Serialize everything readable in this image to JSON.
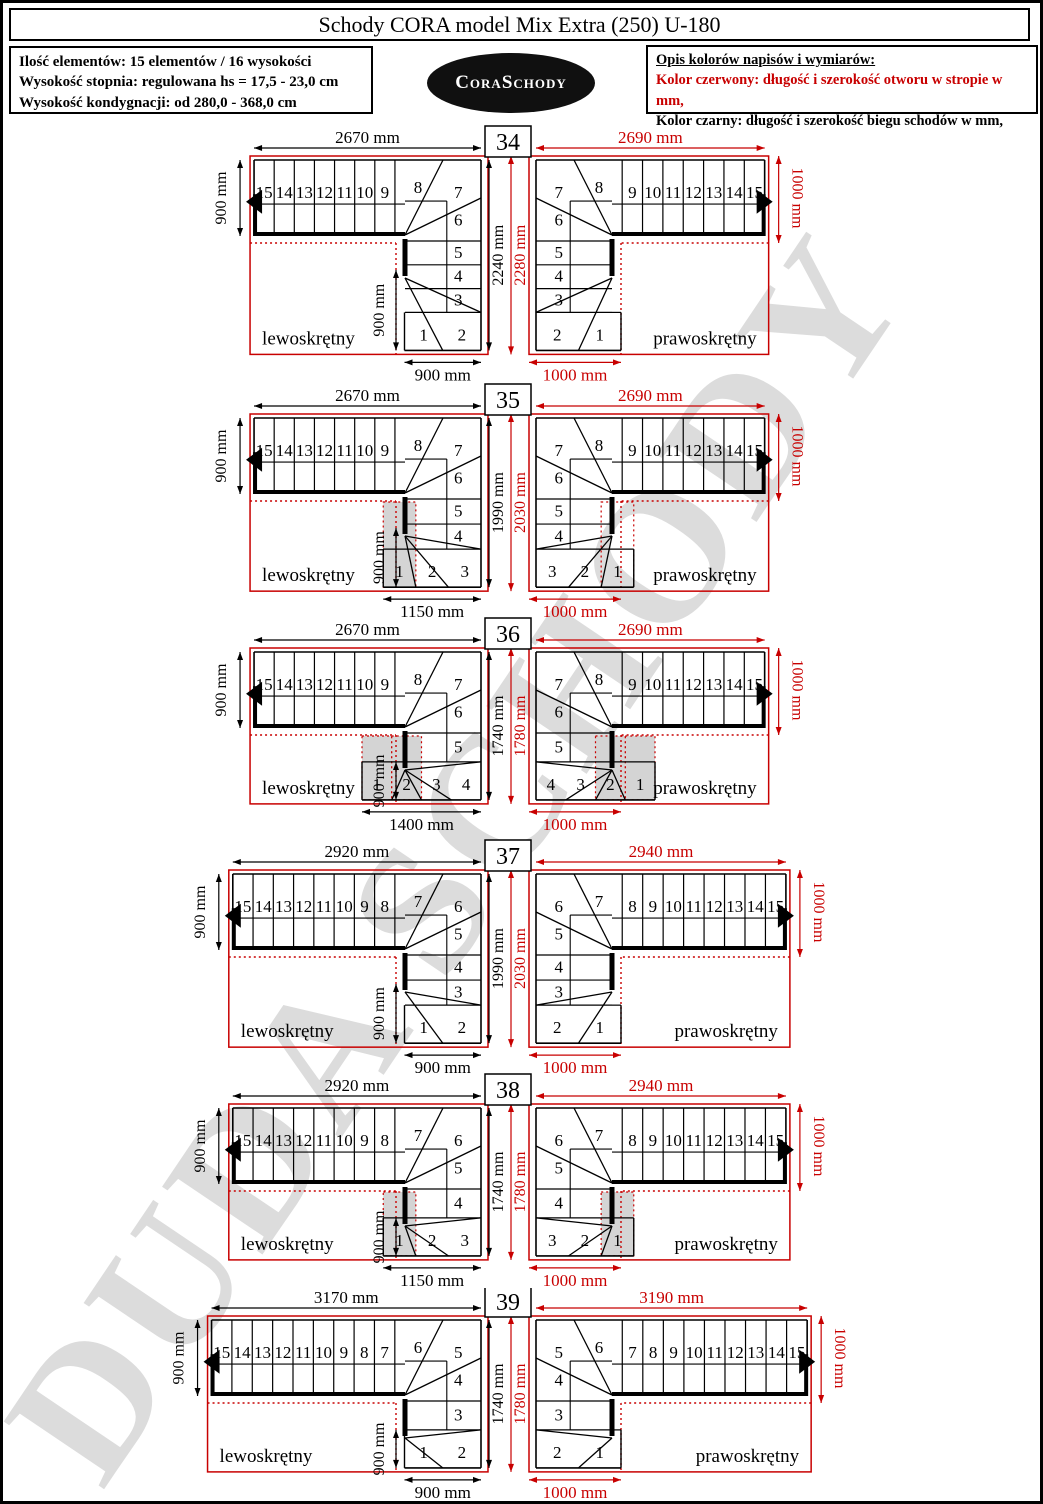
{
  "colors": {
    "red": "#c80000",
    "black": "#000000",
    "grey_step": "#d4d4d4",
    "watermark": "#dcdcdc"
  },
  "header": {
    "title": "Schody CORA model Mix Extra (250) U-180",
    "info_lines": [
      "Ilość elementów: 15 elementów / 16 wysokości",
      "Wysokość stopnia: regulowana  hs = 17,5 - 23,0 cm",
      "Wysokość kondygnacji: od 280,0 - 368,0 cm"
    ],
    "logo_text": "CoraSchody",
    "legend": {
      "heading": "Opis kolorów napisów i wymiarów:",
      "red_line": "Kolor czerwony:  długość i szerokość otworu w stropie w mm,",
      "black_line": "Kolor czarny:  długość i szerokość biegu schodów w mm,"
    }
  },
  "watermark_text": "DUDA SCHODY",
  "rows": [
    {
      "badge": "34",
      "left": {
        "label": "lewoskrętny",
        "top": "2670 mm",
        "side": "900 mm",
        "h_black": "2240 mm",
        "h_red": "2280 mm",
        "bottom": "900 mm",
        "inner": "900 mm",
        "strips": [
          "15",
          "14",
          "13",
          "12",
          "11",
          "10",
          "9"
        ],
        "wedge": "8",
        "corner": "7",
        "column": [
          "6",
          "5",
          "4",
          "3"
        ],
        "bottom_steps": [
          "1",
          "2"
        ],
        "shaded": [],
        "outlined": []
      },
      "right": {
        "label": "prawoskrętny",
        "top": "2690 mm",
        "side": "1000 mm",
        "bottom": "1000 mm",
        "strips": [
          "9",
          "10",
          "11",
          "12",
          "13",
          "14",
          "15"
        ],
        "wedge": "8",
        "corner": "7",
        "column": [
          "6",
          "5",
          "4",
          "3"
        ],
        "bottom_steps": [
          "2",
          "1"
        ],
        "shaded": [],
        "outlined": []
      }
    },
    {
      "badge": "35",
      "left": {
        "label": "lewoskrętny",
        "top": "2670 mm",
        "side": "900 mm",
        "h_black": "1990 mm",
        "h_red": "2030 mm",
        "bottom": "1150 mm",
        "inner": "900 mm",
        "strips": [
          "15",
          "14",
          "13",
          "12",
          "11",
          "10",
          "9"
        ],
        "wedge": "8",
        "corner": "7",
        "column": [
          "6",
          "5",
          "4"
        ],
        "bottom_steps": [
          "1",
          "2",
          "3"
        ],
        "shaded": [
          "1"
        ],
        "outlined": []
      },
      "right": {
        "label": "prawoskrętny",
        "top": "2690 mm",
        "side": "1000 mm",
        "bottom": "1000 mm",
        "strips": [
          "9",
          "10",
          "11",
          "12",
          "13",
          "14",
          "15"
        ],
        "wedge": "8",
        "corner": "7",
        "column": [
          "6",
          "5",
          "4"
        ],
        "bottom_steps": [
          "3",
          "2",
          "1"
        ],
        "shaded": [],
        "outlined": [
          "1"
        ]
      }
    },
    {
      "badge": "36",
      "left": {
        "label": "lewoskrętny",
        "top": "2670 mm",
        "side": "900 mm",
        "h_black": "1740 mm",
        "h_red": "1780 mm",
        "bottom": "1400 mm",
        "inner": "900 mm",
        "strips": [
          "15",
          "14",
          "13",
          "12",
          "11",
          "10",
          "9"
        ],
        "wedge": "8",
        "corner": "7",
        "column": [
          "6",
          "5"
        ],
        "bottom_steps": [
          "1",
          "2",
          "3",
          "4"
        ],
        "shaded": [
          "1",
          "2"
        ],
        "outlined": []
      },
      "right": {
        "label": "prawoskrętny",
        "top": "2690 mm",
        "side": "1000 mm",
        "bottom": "1000 mm",
        "strips": [
          "9",
          "10",
          "11",
          "12",
          "13",
          "14",
          "15"
        ],
        "wedge": "8",
        "corner": "7",
        "column": [
          "6",
          "5"
        ],
        "bottom_steps": [
          "4",
          "3",
          "2",
          "1"
        ],
        "shaded": [
          "2",
          "1"
        ],
        "outlined": []
      }
    },
    {
      "badge": "37",
      "left": {
        "label": "lewoskrętny",
        "top": "2920 mm",
        "side": "900 mm",
        "h_black": "1990 mm",
        "h_red": "2030 mm",
        "bottom": "900 mm",
        "inner": "900 mm",
        "strips": [
          "15",
          "14",
          "13",
          "12",
          "11",
          "10",
          "9",
          "8"
        ],
        "wedge": "7",
        "corner": "6",
        "column": [
          "5",
          "4",
          "3"
        ],
        "bottom_steps": [
          "1",
          "2"
        ],
        "shaded": [],
        "outlined": []
      },
      "right": {
        "label": "prawoskrętny",
        "top": "2940 mm",
        "side": "1000 mm",
        "bottom": "1000 mm",
        "strips": [
          "8",
          "9",
          "10",
          "11",
          "12",
          "13",
          "14",
          "15"
        ],
        "wedge": "7",
        "corner": "6",
        "column": [
          "5",
          "4",
          "3"
        ],
        "bottom_steps": [
          "2",
          "1"
        ],
        "shaded": [],
        "outlined": []
      }
    },
    {
      "badge": "38",
      "left": {
        "label": "lewoskrętny",
        "top": "2920 mm",
        "side": "900 mm",
        "h_black": "1740 mm",
        "h_red": "1780 mm",
        "bottom": "1150 mm",
        "inner": "900 mm",
        "strips": [
          "15",
          "14",
          "13",
          "12",
          "11",
          "10",
          "9",
          "8"
        ],
        "wedge": "7",
        "corner": "6",
        "column": [
          "5",
          "4"
        ],
        "bottom_steps": [
          "1",
          "2",
          "3"
        ],
        "shaded": [
          "1"
        ],
        "outlined": []
      },
      "right": {
        "label": "prawoskrętny",
        "top": "2940 mm",
        "side": "1000 mm",
        "bottom": "1000 mm",
        "strips": [
          "8",
          "9",
          "10",
          "11",
          "12",
          "13",
          "14",
          "15"
        ],
        "wedge": "7",
        "corner": "6",
        "column": [
          "5",
          "4"
        ],
        "bottom_steps": [
          "3",
          "2",
          "1"
        ],
        "shaded": [
          "1"
        ],
        "outlined": []
      }
    },
    {
      "badge": "39",
      "left": {
        "label": "lewoskrętny",
        "top": "3170 mm",
        "side": "900 mm",
        "h_black": "1740 mm",
        "h_red": "1780 mm",
        "bottom": "900 mm",
        "inner": "900 mm",
        "strips": [
          "15",
          "14",
          "13",
          "12",
          "11",
          "10",
          "9",
          "8",
          "7"
        ],
        "wedge": "6",
        "corner": "5",
        "column": [
          "4",
          "3"
        ],
        "bottom_steps": [
          "1",
          "2"
        ],
        "shaded": [],
        "outlined": []
      },
      "right": {
        "label": "prawoskrętny",
        "top": "3190 mm",
        "side": "1000 mm",
        "bottom": "1000 mm",
        "strips": [
          "7",
          "8",
          "9",
          "10",
          "11",
          "12",
          "13",
          "14",
          "15"
        ],
        "wedge": "6",
        "corner": "5",
        "column": [
          "4",
          "3"
        ],
        "bottom_steps": [
          "2",
          "1"
        ],
        "shaded": [],
        "outlined": []
      }
    }
  ]
}
